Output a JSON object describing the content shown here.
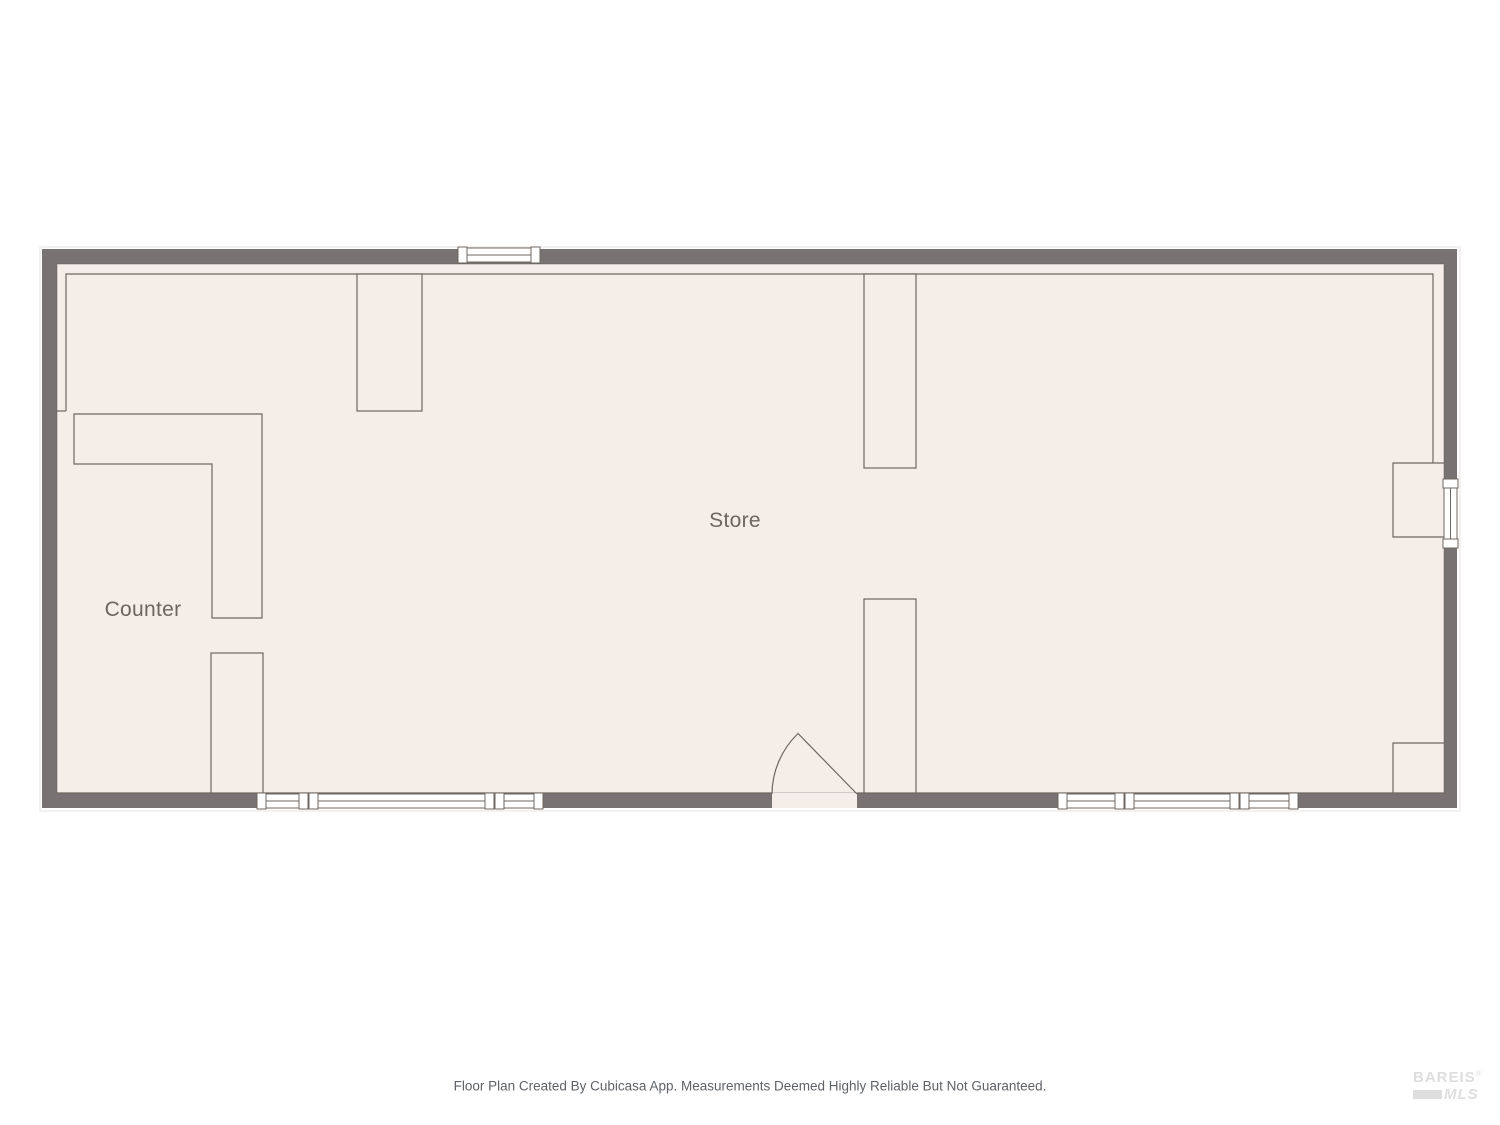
{
  "plan": {
    "rooms": [
      {
        "name": "Store"
      },
      {
        "name": "Counter"
      }
    ]
  },
  "footer": {
    "disclaimer": "Floor Plan Created By Cubicasa App. Measurements Deemed Highly Reliable But Not Guaranteed."
  },
  "logo": {
    "name": "BAREIS",
    "registered": "®",
    "suffix": "MLS"
  },
  "colors": {
    "wall": "#787372",
    "floor": "#f5ede8",
    "line": "#6e6761",
    "window_fill": "#ffffff",
    "label_text": "#6c665f",
    "footer_text": "#5e6266",
    "logo": "#dedede"
  }
}
